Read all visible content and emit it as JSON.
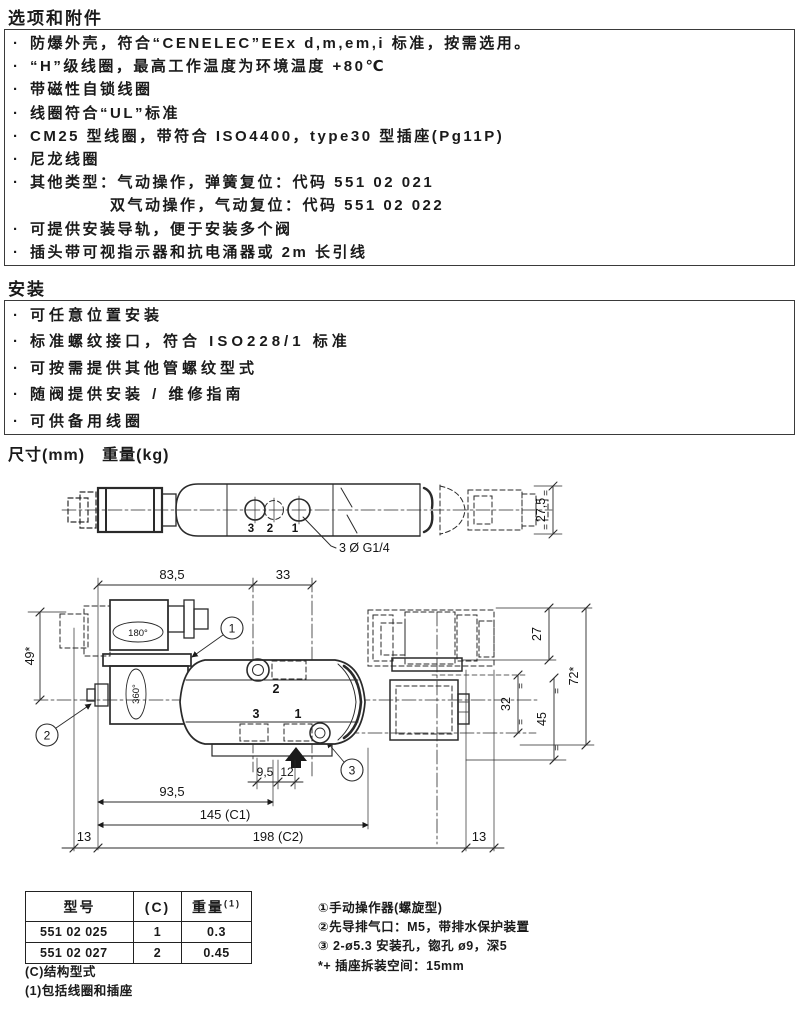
{
  "options": {
    "title": "选项和附件",
    "bullet": "·",
    "items": [
      "防爆外壳，符合“CENELEC”EEx d,m,em,i 标准，按需选用。",
      "“H”级线圈，最高工作温度为环境温度 +80℃",
      "带磁性自锁线圈",
      "线圈符合“UL”标准",
      "CM25 型线圈，带符合 ISO4400，type30 型插座(Pg11P)",
      "尼龙线圈",
      "其他类型：气动操作，弹簧复位：代码 551 02 021",
      "双气动操作，气动复位：代码 551 02 022",
      "可提供安装导轨，便于安装多个阀",
      "插头带可视指示器和抗电涌器或 2m 长引线"
    ]
  },
  "installation": {
    "title": "安装",
    "items": [
      "可任意位置安装",
      "标准螺纹接口，符合 ISO228/1 标准",
      "可按需提供其他管螺纹型式",
      "随阀提供安装 / 维修指南",
      "可供备用线圈"
    ]
  },
  "dimensions_heading": "尺寸(mm)　重量(kg)",
  "drawing": {
    "equal": "=",
    "top_view": {
      "ports": [
        "3",
        "2",
        "1"
      ],
      "leader": "3 Ø G1/4",
      "height": "27,5"
    },
    "side_view": {
      "top_dims": [
        "83,5",
        "33"
      ],
      "left_dim": "49*",
      "rotations": [
        "180°",
        "360°"
      ],
      "callouts": [
        "1",
        "2",
        "3"
      ],
      "body_ports": [
        "2",
        "3",
        "1"
      ],
      "right_dims": [
        "27",
        "72*",
        "45",
        "32"
      ],
      "bottom_dims": [
        "9,5",
        "12",
        "93,5",
        "145 (C1)",
        "198 (C2)"
      ],
      "margins": [
        "13",
        "13"
      ]
    }
  },
  "table": {
    "headers": [
      "型号",
      "(C)",
      "重量"
    ],
    "weight_sup": "(1)",
    "rows": [
      [
        "551 02 025",
        "1",
        "0.3"
      ],
      [
        "551 02 027",
        "2",
        "0.45"
      ]
    ]
  },
  "footnotes": [
    "(C)结构型式",
    "(1)包括线圈和插座"
  ],
  "notes": {
    "items": [
      "①手动操作器(螺旋型)",
      "②先导排气口：M5，带排水保护装置",
      "③ 2-ø5.3 安装孔，锪孔 ø9，深5",
      "*+ 插座拆装空间：15mm"
    ]
  }
}
